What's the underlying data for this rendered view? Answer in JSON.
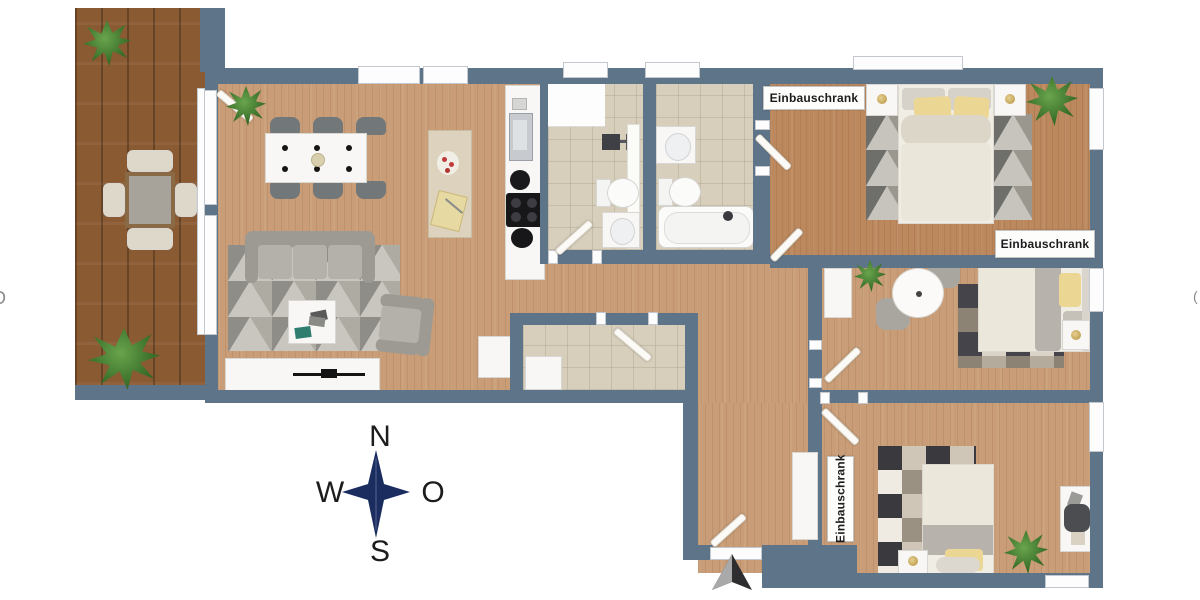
{
  "labels": {
    "wardrobe1": "Einbauschrank",
    "wardrobe2": "Einbauschrank",
    "wardrobe3": "Einbauschrank"
  },
  "compass": {
    "n": "N",
    "w": "W",
    "e": "O",
    "s": "S"
  },
  "edge_glyphs": {
    "left": "D",
    "right": "("
  },
  "icons": {
    "compass": "four-point-star",
    "entrance": "arrow-marker"
  },
  "colors": {
    "wall": "#5e7489",
    "floor_wood": "#c89d77",
    "bedroom_wood": "#bc895f",
    "balcony_wood": "#8a5a33",
    "bathroom_tile": "#d7cebc",
    "furniture_white": "#f8f7f5",
    "sofa_gray": "#a9a6a0",
    "pillow_yellow": "#ecd693",
    "plant_green": "#3f7d2f",
    "compass_navy": "#1b2c5f"
  }
}
